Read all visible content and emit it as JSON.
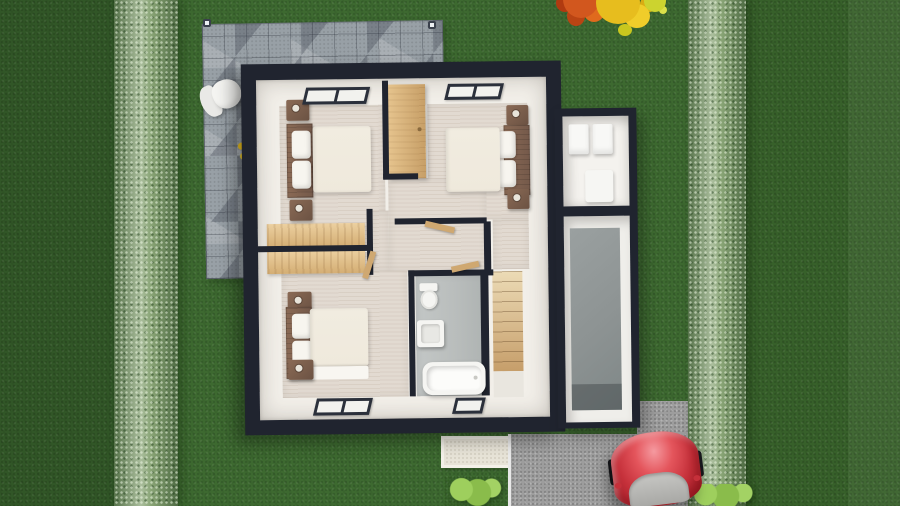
{
  "colors": {
    "grass_mid": "#3d6930",
    "grass_left": "#315627",
    "grass_right": "#37602a",
    "hedge_base": "#8aa577",
    "patio_gray": "#98a0a6",
    "house_dark": "#20242f",
    "interior_white": "#f2efe9",
    "floor_beige": "#e2dad1",
    "bath_gray": "#b9bdbc",
    "wood_light": "#ddba85",
    "wood_dark": "#7d6150",
    "duvet_cream": "#efe9dc",
    "pillow_white": "#f7f5ef",
    "fixture_white": "#f5f5f2",
    "stairs_wood_light": "#ecdbb6",
    "stairs_wood_dark": "#c69e6a",
    "garage_floor": "#8d9393",
    "driveway_gray": "#9d9d9d",
    "walkway_light": "#e7e3d7",
    "car_red": "#c5303a",
    "car_glass": "#b5b5b2",
    "bush_green": "#8abc4b",
    "tree_orange": "#d2571e",
    "tree_yellow": "#e7bd1e",
    "window_frame": "#2b303b"
  },
  "scene": {
    "description": "Top-down 3D rendering of a house upper-floor plan set in a green garden",
    "outdoor": {
      "lawn": "green grass on all sides",
      "hedges": [
        "left boundary hedge",
        "right boundary hedge"
      ],
      "tree": "orange-yellow autumn tree at top right",
      "patio": "grey stone paver terrace at top left",
      "patio_items": [
        "white garden chair",
        "yellow flowers",
        "corner spotlight",
        "corner spotlight"
      ],
      "walkway": "light front walkway below house",
      "driveway": "grey speckled driveway at bottom right",
      "vehicle": "red car parked on driveway",
      "bushes": [
        "light green bush near walkway",
        "light green bush at bottom right"
      ]
    },
    "floorplan": {
      "rooms": [
        {
          "name": "bedroom-1",
          "position": "top-left",
          "contents": [
            "double bed",
            "2 pillows",
            "2 nightstands",
            "desk",
            "window"
          ]
        },
        {
          "name": "bedroom-2",
          "position": "top-right",
          "contents": [
            "double bed",
            "2 pillows",
            "2 nightstands",
            "window"
          ]
        },
        {
          "name": "bedroom-3",
          "position": "bottom-left",
          "contents": [
            "double bed",
            "2 pillows",
            "2 nightstands",
            "desk",
            "window"
          ]
        },
        {
          "name": "bathroom",
          "position": "bottom-center",
          "contents": [
            "toilet",
            "washbasin",
            "bathtub",
            "window"
          ]
        },
        {
          "name": "landing",
          "position": "center",
          "contents": [
            "wooden wardrobe",
            "corridor"
          ]
        },
        {
          "name": "staircase",
          "position": "bottom-right",
          "contents": [
            "wooden steps"
          ]
        },
        {
          "name": "utility-room",
          "position": "annex-top",
          "contents": [
            "washer",
            "dryer",
            "water heater"
          ]
        },
        {
          "name": "garage",
          "position": "annex-bottom",
          "contents": [
            "grey concrete floor"
          ]
        }
      ],
      "window_count": 4,
      "door_count": 3
    }
  }
}
